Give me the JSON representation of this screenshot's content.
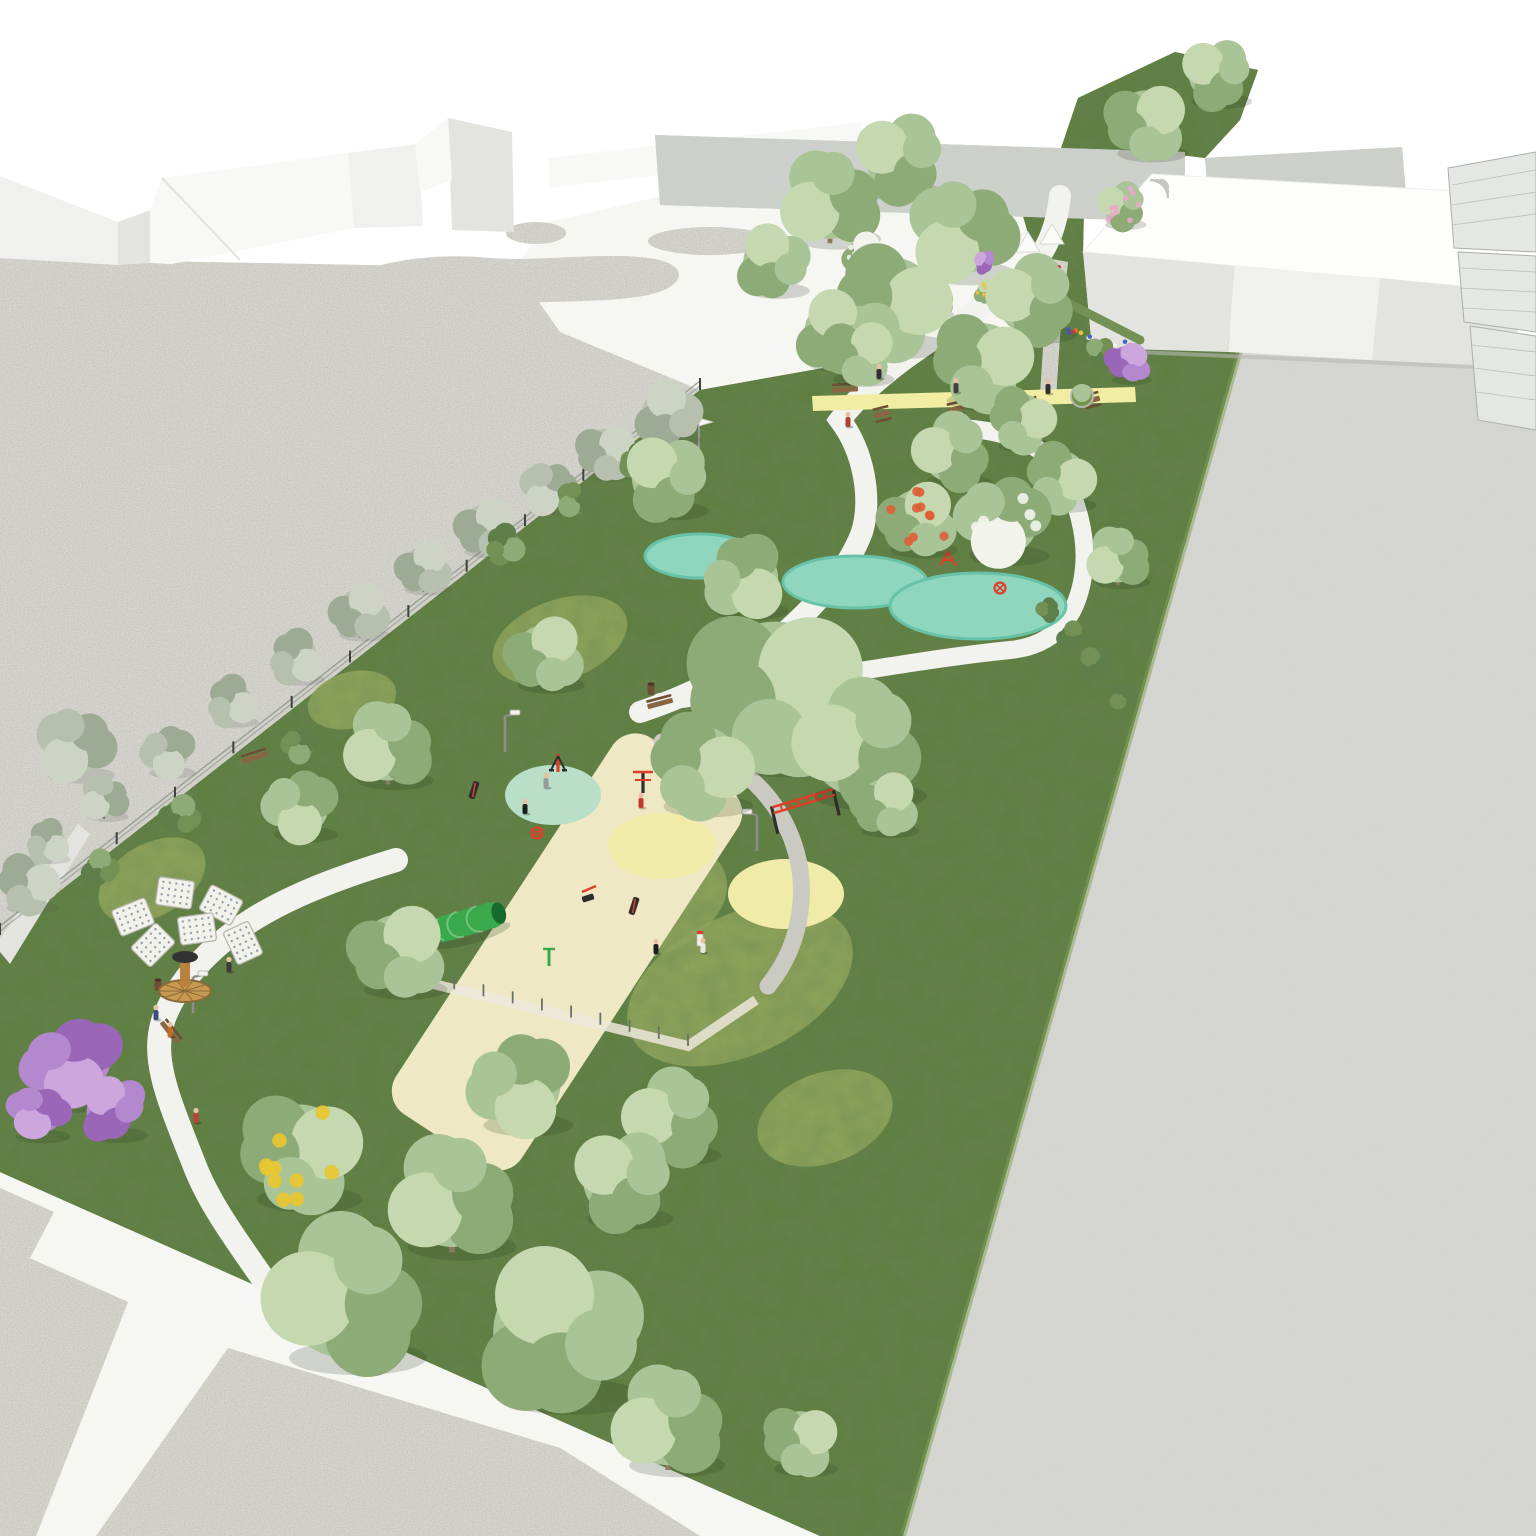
{
  "palette": {
    "bg": "#ffffff",
    "plaza": "#f6f6f3",
    "path": "#f2f2ef",
    "gravel": "#d7d6cf",
    "gravel_dark": "#cbcac2",
    "road": "#d6d6d2",
    "grass": "#5e7d3e",
    "grass_light": "#74944c",
    "meadow": "#97ab5e",
    "meadow_light": "#aab96c",
    "fitness_surface": "#eee9c4",
    "circle_mint": "#b9dfc9",
    "circle_yellow": "#f1ebA9",
    "strip_yellow": "#f1eda2",
    "teal": "#8fd6bf",
    "teal_dark": "#67c2a8",
    "foliage": "#a9c497",
    "foliage_dark": "#8cab77",
    "foliage_light": "#c5d8af",
    "foliage_context": "#b7c0af",
    "foliage_context_dark": "#9daa94",
    "foliage_context_light": "#cdd4c6",
    "bush_dark": "#5f7f4a",
    "hedge": "#739055",
    "trunk": "#8a7a5e",
    "trunk_gray": "#74746c",
    "bwall": "#f0f0ee",
    "bwall_light": "#f8f8f6",
    "bwall_dark": "#e3e3e0",
    "building_white": "#fdfdfc",
    "context_bldg": "#cdd1cb",
    "mesh_fill": "#e4e7e3",
    "mesh_line": "#aab0aa",
    "equipment_red": "#df3f28",
    "equipment_black": "#2e2e2e",
    "green_equipment": "#3aa94b",
    "wood": "#8a6544",
    "wood_dark": "#6e4f36",
    "purple": "#b488cf",
    "purple_dark": "#9a66b8",
    "purple_light": "#cda6de",
    "yellow_flower": "#e9c72f",
    "orange_flower": "#e5702c",
    "blue_flower": "#4a66c0",
    "red_flower": "#d84040",
    "red_blossom": "#de5f36",
    "pink_blossom": "#eaa8c6",
    "white_blossom": "#f2f4ec",
    "metal": "#8e8e8a",
    "skin": "#e6c2a3",
    "panel": "#f2f2ec"
  },
  "scene": {
    "type": "aerial architectural render of a linear pocket park between existing buildings and a road",
    "trees": [
      {
        "x": 665,
        "y": 478,
        "r": 46,
        "t": "park"
      },
      {
        "x": 775,
        "y": 690,
        "r": 95,
        "t": "park"
      },
      {
        "x": 860,
        "y": 746,
        "r": 70,
        "t": "park"
      },
      {
        "x": 700,
        "y": 766,
        "r": 56,
        "t": "park"
      },
      {
        "x": 545,
        "y": 655,
        "r": 42,
        "t": "park"
      },
      {
        "x": 388,
        "y": 746,
        "r": 48,
        "t": "park"
      },
      {
        "x": 300,
        "y": 806,
        "r": 40,
        "t": "park"
      },
      {
        "x": 345,
        "y": 1296,
        "r": 86,
        "t": "park"
      },
      {
        "x": 558,
        "y": 1332,
        "r": 90,
        "t": "park"
      },
      {
        "x": 452,
        "y": 1198,
        "r": 68,
        "t": "park"
      },
      {
        "x": 668,
        "y": 1422,
        "r": 60,
        "t": "park"
      },
      {
        "x": 622,
        "y": 1180,
        "r": 54,
        "t": "park"
      },
      {
        "x": 398,
        "y": 952,
        "r": 52,
        "t": "park"
      },
      {
        "x": 520,
        "y": 1085,
        "r": 56,
        "t": "park"
      },
      {
        "x": 672,
        "y": 1118,
        "r": 52,
        "t": "park"
      },
      {
        "x": 830,
        "y": 200,
        "r": 54,
        "t": "park"
      },
      {
        "x": 900,
        "y": 158,
        "r": 48,
        "t": "park"
      },
      {
        "x": 962,
        "y": 232,
        "r": 58,
        "t": "park"
      },
      {
        "x": 892,
        "y": 302,
        "r": 62,
        "t": "park"
      },
      {
        "x": 982,
        "y": 362,
        "r": 54,
        "t": "park"
      },
      {
        "x": 1032,
        "y": 300,
        "r": 48,
        "t": "park"
      },
      {
        "x": 836,
        "y": 332,
        "r": 44,
        "t": "park"
      },
      {
        "x": 772,
        "y": 262,
        "r": 40,
        "t": "park"
      },
      {
        "x": 1146,
        "y": 122,
        "r": 44,
        "t": "park"
      },
      {
        "x": 1216,
        "y": 74,
        "r": 38,
        "t": "park"
      },
      {
        "x": 1060,
        "y": 478,
        "r": 38,
        "t": "park"
      },
      {
        "x": 1118,
        "y": 558,
        "r": 34,
        "t": "park"
      },
      {
        "x": 952,
        "y": 452,
        "r": 42,
        "t": "park"
      },
      {
        "x": 1022,
        "y": 420,
        "r": 36,
        "t": "park"
      },
      {
        "x": 858,
        "y": 352,
        "r": 38,
        "t": "park"
      },
      {
        "x": 800,
        "y": 1440,
        "r": 40,
        "t": "park"
      },
      {
        "x": 745,
        "y": 578,
        "r": 46,
        "t": "park"
      },
      {
        "x": 885,
        "y": 805,
        "r": 36,
        "t": "park"
      },
      {
        "x": 668,
        "y": 414,
        "r": 36,
        "t": "context"
      },
      {
        "x": 606,
        "y": 452,
        "r": 32,
        "t": "context"
      },
      {
        "x": 548,
        "y": 488,
        "r": 30,
        "t": "context"
      },
      {
        "x": 486,
        "y": 528,
        "r": 33,
        "t": "context"
      },
      {
        "x": 424,
        "y": 568,
        "r": 30,
        "t": "context"
      },
      {
        "x": 360,
        "y": 612,
        "r": 32,
        "t": "context"
      },
      {
        "x": 296,
        "y": 658,
        "r": 30,
        "t": "context"
      },
      {
        "x": 232,
        "y": 702,
        "r": 28,
        "t": "context"
      },
      {
        "x": 168,
        "y": 752,
        "r": 29,
        "t": "context"
      },
      {
        "x": 104,
        "y": 798,
        "r": 26,
        "t": "context"
      },
      {
        "x": 48,
        "y": 842,
        "r": 24,
        "t": "context"
      },
      {
        "x": 75,
        "y": 745,
        "r": 42,
        "t": "context"
      },
      {
        "x": 28,
        "y": 884,
        "r": 33,
        "t": "context"
      },
      {
        "x": 1002,
        "y": 520,
        "r": 50,
        "t": "white"
      },
      {
        "x": 865,
        "y": 255,
        "r": 24,
        "t": "white"
      },
      {
        "x": 935,
        "y": 300,
        "r": 20,
        "t": "white"
      },
      {
        "x": 1122,
        "y": 206,
        "r": 26,
        "t": "pink"
      },
      {
        "x": 918,
        "y": 520,
        "r": 42,
        "t": "red"
      },
      {
        "x": 300,
        "y": 1152,
        "r": 66,
        "t": "laburnum"
      },
      {
        "x": 986,
        "y": 292,
        "r": 13,
        "t": "laburnum"
      },
      {
        "x": 1072,
        "y": 636,
        "r": 16,
        "t": "dark"
      },
      {
        "x": 1094,
        "y": 664,
        "r": 18,
        "t": "dark"
      },
      {
        "x": 1122,
        "y": 696,
        "r": 15,
        "t": "dark"
      },
      {
        "x": 1048,
        "y": 610,
        "r": 13,
        "t": "dark"
      },
      {
        "x": 640,
        "y": 462,
        "r": 22,
        "t": "hedge"
      },
      {
        "x": 575,
        "y": 500,
        "r": 20,
        "t": "hedge"
      },
      {
        "x": 505,
        "y": 545,
        "r": 22,
        "t": "hedge"
      },
      {
        "x": 300,
        "y": 745,
        "r": 20,
        "t": "hedge"
      },
      {
        "x": 180,
        "y": 815,
        "r": 22,
        "t": "hedge"
      },
      {
        "x": 100,
        "y": 868,
        "r": 20,
        "t": "hedge"
      },
      {
        "x": 1100,
        "y": 352,
        "r": 16,
        "t": "hedge"
      },
      {
        "x": 72,
        "y": 1062,
        "r": 55,
        "t": "purple"
      },
      {
        "x": 112,
        "y": 1108,
        "r": 38,
        "t": "purple"
      },
      {
        "x": 38,
        "y": 1112,
        "r": 34,
        "t": "purple"
      },
      {
        "x": 1128,
        "y": 362,
        "r": 25,
        "t": "purple"
      },
      {
        "x": 984,
        "y": 262,
        "r": 13,
        "t": "purple"
      }
    ],
    "meadow_patches": [
      {
        "x": 560,
        "y": 640,
        "rx": 70,
        "ry": 40,
        "a": -20
      },
      {
        "x": 740,
        "y": 985,
        "rx": 120,
        "ry": 70,
        "a": -25
      },
      {
        "x": 645,
        "y": 902,
        "rx": 85,
        "ry": 55,
        "a": -20
      },
      {
        "x": 352,
        "y": 700,
        "rx": 45,
        "ry": 28,
        "a": -15
      },
      {
        "x": 152,
        "y": 880,
        "rx": 58,
        "ry": 36,
        "a": -30
      },
      {
        "x": 825,
        "y": 1118,
        "rx": 70,
        "ry": 45,
        "a": -20
      }
    ],
    "people": [
      {
        "x": 525,
        "y": 808,
        "c": "#1d1d1f"
      },
      {
        "x": 546,
        "y": 782,
        "c": "#9a9a9a"
      },
      {
        "x": 641,
        "y": 802,
        "c": "#c0392b"
      },
      {
        "x": 656,
        "y": 948,
        "c": "#1d1d1f"
      },
      {
        "x": 703,
        "y": 947,
        "c": "#e8e8e8"
      },
      {
        "x": 879,
        "y": 373,
        "c": "#2f2f33"
      },
      {
        "x": 1048,
        "y": 388,
        "c": "#2f2f33"
      },
      {
        "x": 956,
        "y": 387,
        "c": "#44413c"
      },
      {
        "x": 848,
        "y": 421,
        "c": "#b04030"
      },
      {
        "x": 156,
        "y": 1014,
        "c": "#35507a"
      },
      {
        "x": 170,
        "y": 1031,
        "c": "#c56a22"
      },
      {
        "x": 229,
        "y": 966,
        "c": "#3a3a3c"
      },
      {
        "x": 196,
        "y": 1117,
        "c": "#c04038"
      }
    ],
    "lamps": [
      {
        "x": 193,
        "y": 1013,
        "d": 1
      },
      {
        "x": 505,
        "y": 752,
        "d": 1
      },
      {
        "x": 757,
        "y": 851,
        "d": -1
      },
      {
        "x": 877,
        "y": 341,
        "d": -1
      }
    ],
    "benches": [
      {
        "x": 660,
        "y": 703,
        "a": -15
      },
      {
        "x": 170,
        "y": 1032,
        "a": 52
      },
      {
        "x": 845,
        "y": 389,
        "a": -3
      },
      {
        "x": 255,
        "y": 757,
        "a": -18
      },
      {
        "x": 915,
        "y": 506,
        "a": -12
      }
    ],
    "picnic_tables": [
      {
        "x": 882,
        "y": 414
      },
      {
        "x": 956,
        "y": 409
      },
      {
        "x": 1030,
        "y": 405
      },
      {
        "x": 1092,
        "y": 400
      }
    ],
    "planters": [
      {
        "x": 1082,
        "y": 396
      }
    ],
    "bins": [
      {
        "x": 651,
        "y": 690
      },
      {
        "x": 158,
        "y": 986
      }
    ],
    "kiosks": [
      {
        "x": 117,
        "y": 1104,
        "a": 12
      }
    ],
    "equipment": [
      {
        "x": 558,
        "y": 772,
        "t": "airwalker"
      },
      {
        "x": 643,
        "y": 793,
        "t": "pullup"
      },
      {
        "x": 775,
        "y": 820,
        "t": "monkeybars"
      },
      {
        "x": 537,
        "y": 833,
        "t": "spinner"
      },
      {
        "x": 588,
        "y": 898,
        "t": "legpress"
      },
      {
        "x": 634,
        "y": 906,
        "t": "board"
      },
      {
        "x": 474,
        "y": 790,
        "t": "board"
      },
      {
        "x": 700,
        "y": 944,
        "t": "fountain"
      },
      {
        "x": 1000,
        "y": 588,
        "t": "spinner"
      },
      {
        "x": 948,
        "y": 562,
        "t": "climber"
      }
    ],
    "tunnel": {
      "x": 468,
      "y": 922,
      "a": -16
    },
    "shower": {
      "x": 549,
      "y": 966
    },
    "solar_tree": {
      "x": 185,
      "y": 985
    },
    "flags": [
      {
        "x": 699,
        "y": 462
      }
    ],
    "tents": [
      {
        "x": 1028,
        "y": 252
      },
      {
        "x": 1052,
        "y": 244
      }
    ],
    "amphitheater": {
      "x": 1168,
      "y": 180
    },
    "flower_beds": [
      {
        "x1": 1052,
        "y1": 262,
        "x2": 1066,
        "y2": 330,
        "n": 16
      },
      {
        "x1": 1066,
        "y1": 332,
        "x2": 1138,
        "y2": 350,
        "n": 14
      }
    ],
    "flower_colors": [
      "blue_flower",
      "orange_flower",
      "red_flower",
      "yellow_flower",
      "white_blossom"
    ]
  }
}
